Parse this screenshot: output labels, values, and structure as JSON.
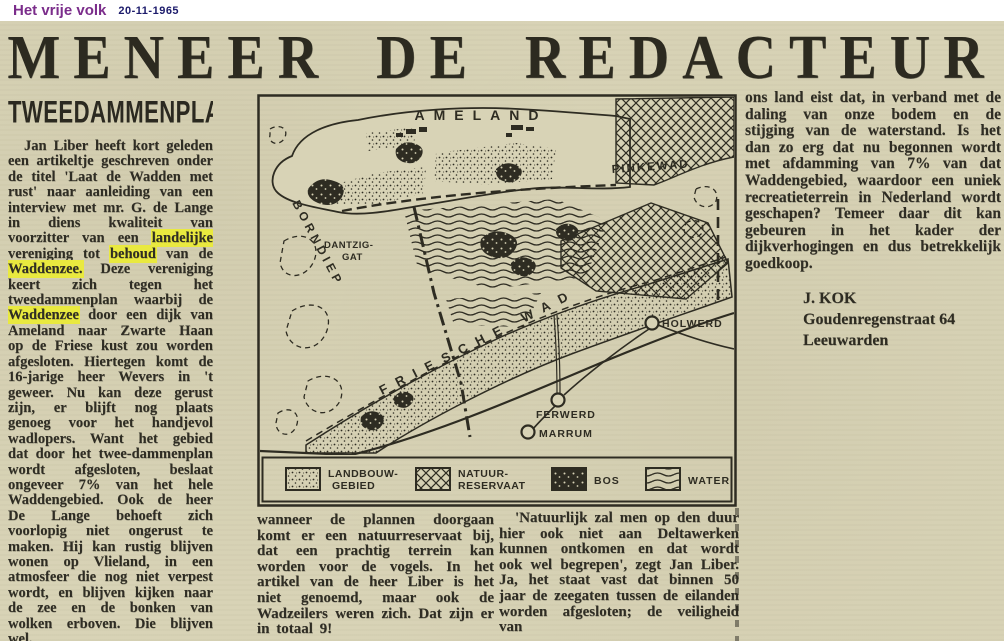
{
  "masthead": {
    "paper_name": "Het vrije volk",
    "date": "20-11-1965"
  },
  "headline": "MENEER DE REDACTEUR",
  "article": {
    "section_title": "TWEEDAMMENPLAN",
    "col_left": {
      "p1_seg1": "Jan Liber heeft kort geleden een artikeltje geschreven onder de titel 'Laat de Wadden met rust' naar aanleiding van een interview met mr. G. de Lange in diens kwaliteit van voorzitter van een ",
      "p1_hl1": "landelijke",
      "p1_seg2": " vereniging tot ",
      "p1_hl2": "behoud",
      "p1_seg3": " van de ",
      "p1_hl3": "Waddenzee.",
      "p1_seg4": " Deze vereniging keert zich tegen het tweedammenplan waarbij de ",
      "p1_hl4": "Waddenzee",
      "p1_seg5": " door een dijk van Ameland naar Zwarte Haan op de Friese kust zou worden afgesloten. Hiertegen komt de 16-jarige heer Wevers in 't geweer. Nu kan deze gerust zijn, er blijft nog plaats genoeg voor het handjevol wadlopers. Want het gebied dat door het twee-dammenplan wordt afgesloten, beslaat ongeveer 7% van het hele Waddengebied. Ook de heer De Lange behoeft zich voorlopig niet ongerust te maken. Hij kan rustig blijven wonen op Vlieland, in een atmosfeer die nog niet verpest wordt, en blijven kijken naar de zee en de bonken van wolken erboven. Die blijven wel.",
      "p2": "Wat de vogels betreft,"
    },
    "col_mid1": "wanneer de plannen doorgaan komt er een natuurreservaat bij, dat een prachtig terrein kan worden voor de vogels. In het artikel van de heer Liber is het niet genoemd, maar ook de Wadzeilers weren zich. Dat zijn er in totaal 9!",
    "col_mid2": "'Natuurlijk zal men op den duur hier ook niet aan Deltawerken kunnen ontkomen en dat wordt ook wel begrepen', zegt Jan Liber. Ja, het staat vast dat binnen 50 jaar de zeegaten tussen de eilanden worden afgesloten; de veiligheid van",
    "col_right": "ons land eist dat, in verband met de daling van onze bodem en de stijging van de waterstand. Is het dan zo erg dat nu begonnen wordt met afdamming van 7% van dat Waddengebied, waardoor een uniek recreatieterrein in Nederland wordt geschapen? Temeer daar dit kan gebeuren in het kader der dijkverhogingen en dus betrekkelijk goedkoop.",
    "signature": {
      "name": "J. KOK",
      "street": "Goudenregenstraat 64",
      "city": "Leeuwarden"
    }
  },
  "map": {
    "labels": {
      "island": "AMELAND",
      "channel_west": "BORNDIEP",
      "gat_line1": "DANTZIG-",
      "gat_line2": "GAT",
      "wad_east": "PINKEWAD",
      "wad_main": "FRIESCHE  WAD",
      "town1": "HOLWERD",
      "town2": "FERWERD",
      "town3": "MARRUM"
    },
    "legend": [
      {
        "pattern": "stipple",
        "line1": "LANDBOUW-",
        "line2": "GEBIED"
      },
      {
        "pattern": "crosshatch",
        "line1": "NATUUR-",
        "line2": "RESERVAAT"
      },
      {
        "pattern": "forest",
        "line1": "BOS",
        "line2": ""
      },
      {
        "pattern": "waves",
        "line1": "WATER",
        "line2": ""
      }
    ]
  },
  "colors": {
    "paper": "#d8d3b6",
    "ink": "#2e2c22",
    "masthead_purple": "#7b2d8b",
    "masthead_date_blue": "#1c1b6b",
    "highlight_yellow": "#e9e93f"
  }
}
